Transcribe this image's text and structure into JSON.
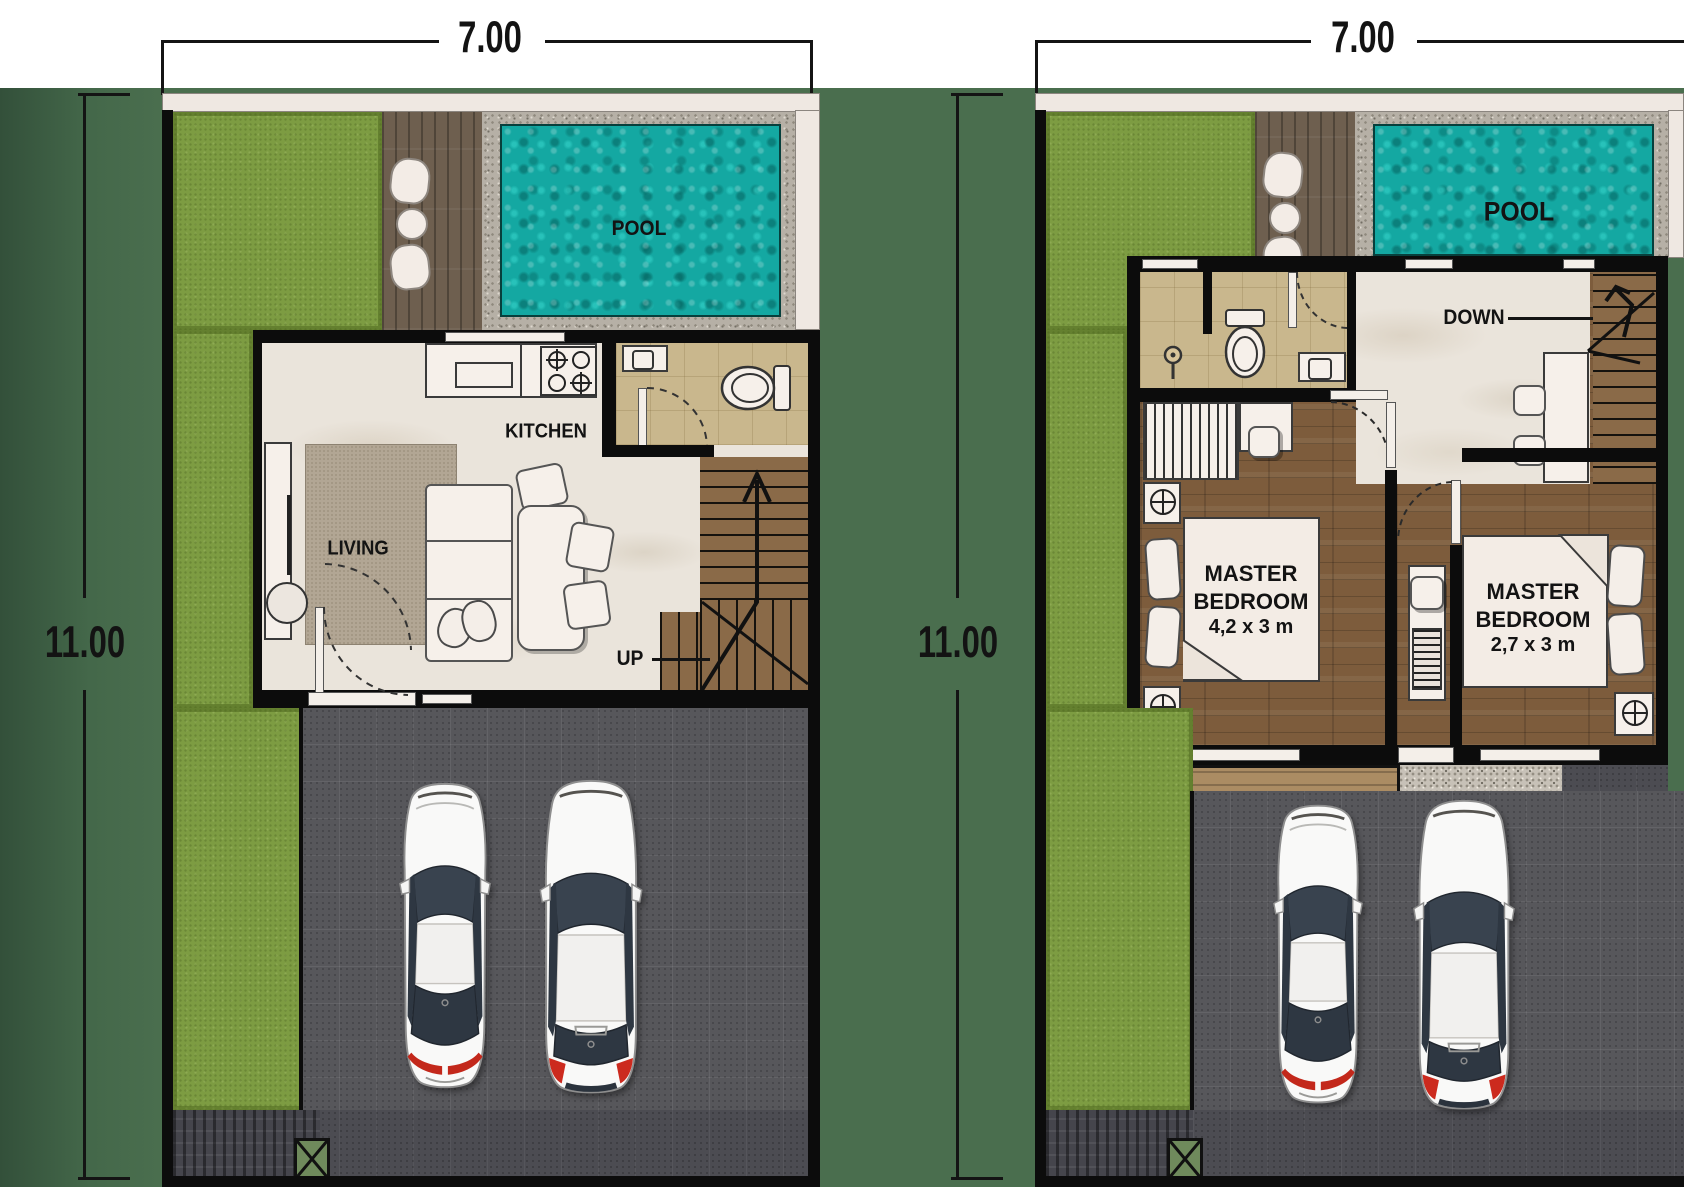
{
  "site": {
    "background_color": "#4a6e4e",
    "lawn_color": "#7d9c42",
    "pool_color": "#14a8a2",
    "wall_color": "#0c0c0c",
    "driveway_color": "#57575b",
    "wood_floor_color": "#7d5c3c"
  },
  "plans": [
    {
      "name": "ground-floor",
      "width_label": "7.00",
      "height_label": "11.00",
      "pool_label": "POOL",
      "kitchen_label": "KITCHEN",
      "living_label": "LIVING",
      "stair_label": "UP"
    },
    {
      "name": "upper-floor",
      "width_label": "7.00",
      "height_label": "11.00",
      "pool_label": "POOL",
      "stair_label": "DOWN",
      "bedroom1_name": "MASTER BEDROOM",
      "bedroom1_size": "4,2 x 3 m",
      "bedroom2_name": "MASTER BEDROOM",
      "bedroom2_size": "2,7 x 3 m"
    }
  ]
}
